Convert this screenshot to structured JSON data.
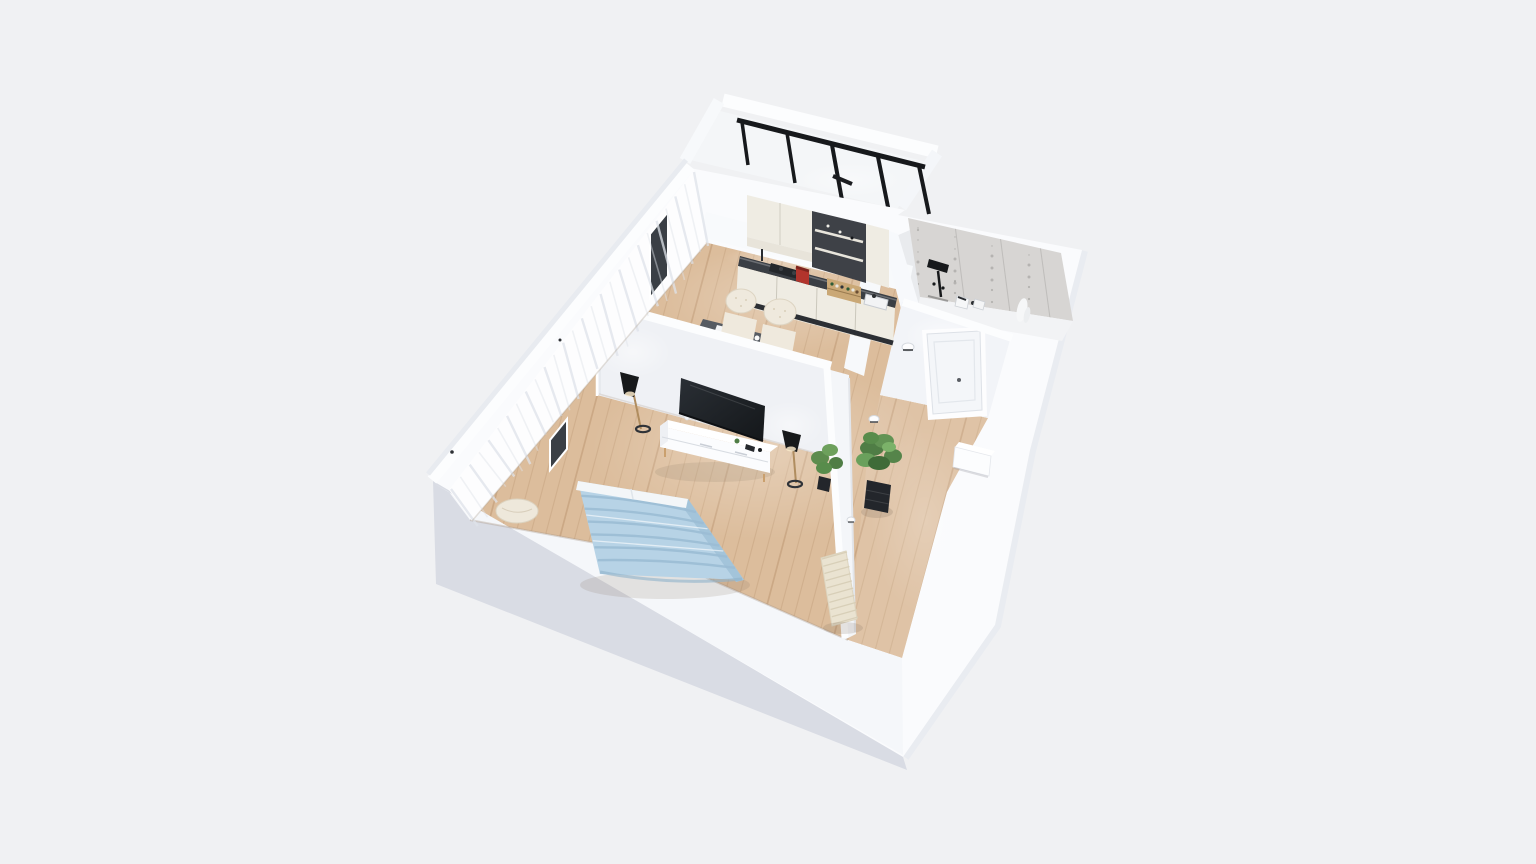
{
  "scene": {
    "type": "3d-floorplan-render",
    "description": "isometric cutaway render of a one-bedroom apartment, no visible text",
    "background": "#f0f1f3",
    "colors": {
      "wall_top": "#fcfdfe",
      "wall_face": "#f1f3f6",
      "wall_shell": "#fafbfd",
      "wall_exterior_shaded": "#d9dce4",
      "wall_exterior_light": "#e8ebf0",
      "floor_wood": "#dcbd9c",
      "floor_plank_line": "#96693f",
      "concrete": "#d7d5d3",
      "window_frame": "#17191c",
      "tv_screen": "#1d2125",
      "bed_blanket": "#b7d3e6",
      "bed_blanket_shade": "#9bbdd4",
      "counter_top": "#3a3e44",
      "cabinet_cream": "#efece3",
      "chair_cream": "#efe9dd",
      "coffee_machine_red": "#b2342c",
      "plant_green": "#5d8c4e",
      "planter_dark": "#23262b",
      "radiator_beige": "#eae3d1",
      "table_top": "#565b62",
      "lamp_black": "#17191b",
      "lamp_pole": "#b08d5f",
      "spice_rack_wood": "#caa876"
    },
    "rooms": [
      {
        "name": "balcony"
      },
      {
        "name": "kitchen-dining"
      },
      {
        "name": "bathroom"
      },
      {
        "name": "hallway"
      },
      {
        "name": "living-bedroom"
      }
    ],
    "furniture": [
      "balcony-window-wall",
      "kitchen-upper-cabinets",
      "open-shelf-unit",
      "kitchen-counter",
      "cooktop",
      "coffee-machine",
      "spice-rack",
      "kitchen-sink",
      "dining-table",
      "dining-chairs",
      "tv",
      "tv-console",
      "floor-lamps",
      "bed",
      "pouf",
      "curtains",
      "window-slits",
      "entry-door",
      "wall-sconces",
      "potted-plant",
      "small-plant",
      "radiator",
      "shoe-cabinet",
      "shower-fixture",
      "bathroom-fixtures",
      "decor-sculpture"
    ]
  }
}
